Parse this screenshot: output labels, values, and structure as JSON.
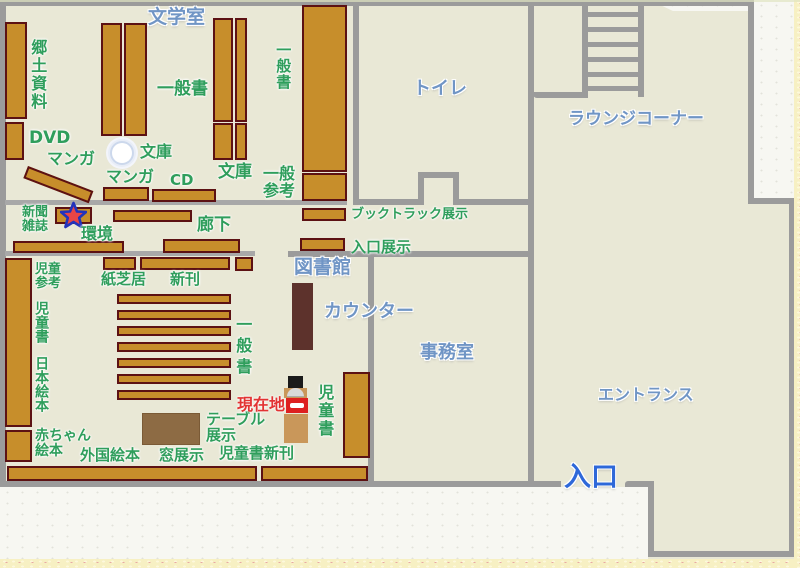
{
  "page": {
    "type": "library-floor-map"
  },
  "rooms": {
    "bungaku_room": "文学室",
    "toilet": "トイレ",
    "lounge_corner": "ラウンジコーナー",
    "library": "図書館",
    "counter": "カウンター",
    "office": "事務室",
    "entrance_hall": "エントランス",
    "entrance": "入口"
  },
  "sections": {
    "kyodo_shiryo": "郷土資料",
    "dvd": "DVD",
    "manga_wall": "マンガ",
    "ippansho_top": "一般書",
    "bunko_pillar": "文庫",
    "manga_center": "マンガ",
    "cd": "CD",
    "bunko_right": "文庫",
    "ippan_sanko": "一般\n参考",
    "ippansho_right": "一般書",
    "booktruck_display": "ブックトラック展示",
    "entrance_display": "入口展示",
    "shimbun_zasshi": "新聞\n雑誌",
    "kankyo": "環境",
    "roka": "廊下",
    "jido_sanko": "児童\n参考",
    "kamishibai": "紙芝居",
    "shinkan": "新刊",
    "jidosho_left": "児童書",
    "ippansho_children": "一般書",
    "nihon_ehon": "日本絵本",
    "akachan_ehon": "赤ちゃん\n絵本",
    "gaikoku_ehon": "外国絵本",
    "table_display": "テーブル\n展示",
    "mado_display": "窓展示",
    "jidosho_shinkan": "児童書新刊",
    "jidosho_right": "児童書",
    "current_location": "現在地"
  },
  "markers": {
    "star": "current-location-star",
    "pillar": "bunko-pillar",
    "person": "person-at-current-location"
  },
  "colors": {
    "floor": "#e9e8d6",
    "wall": "#9b9b9b",
    "shelf_fill": "#c78e2b",
    "shelf_border": "#5c1113",
    "green_label": "#2f9e5c",
    "blue_label": "#7095c5",
    "entrance_blue": "#2e68d9",
    "red_label": "#e23333",
    "counter": "#5d322c",
    "table": "#8d6b44",
    "star_fill": "#e84545",
    "star_border": "#2233bb"
  }
}
